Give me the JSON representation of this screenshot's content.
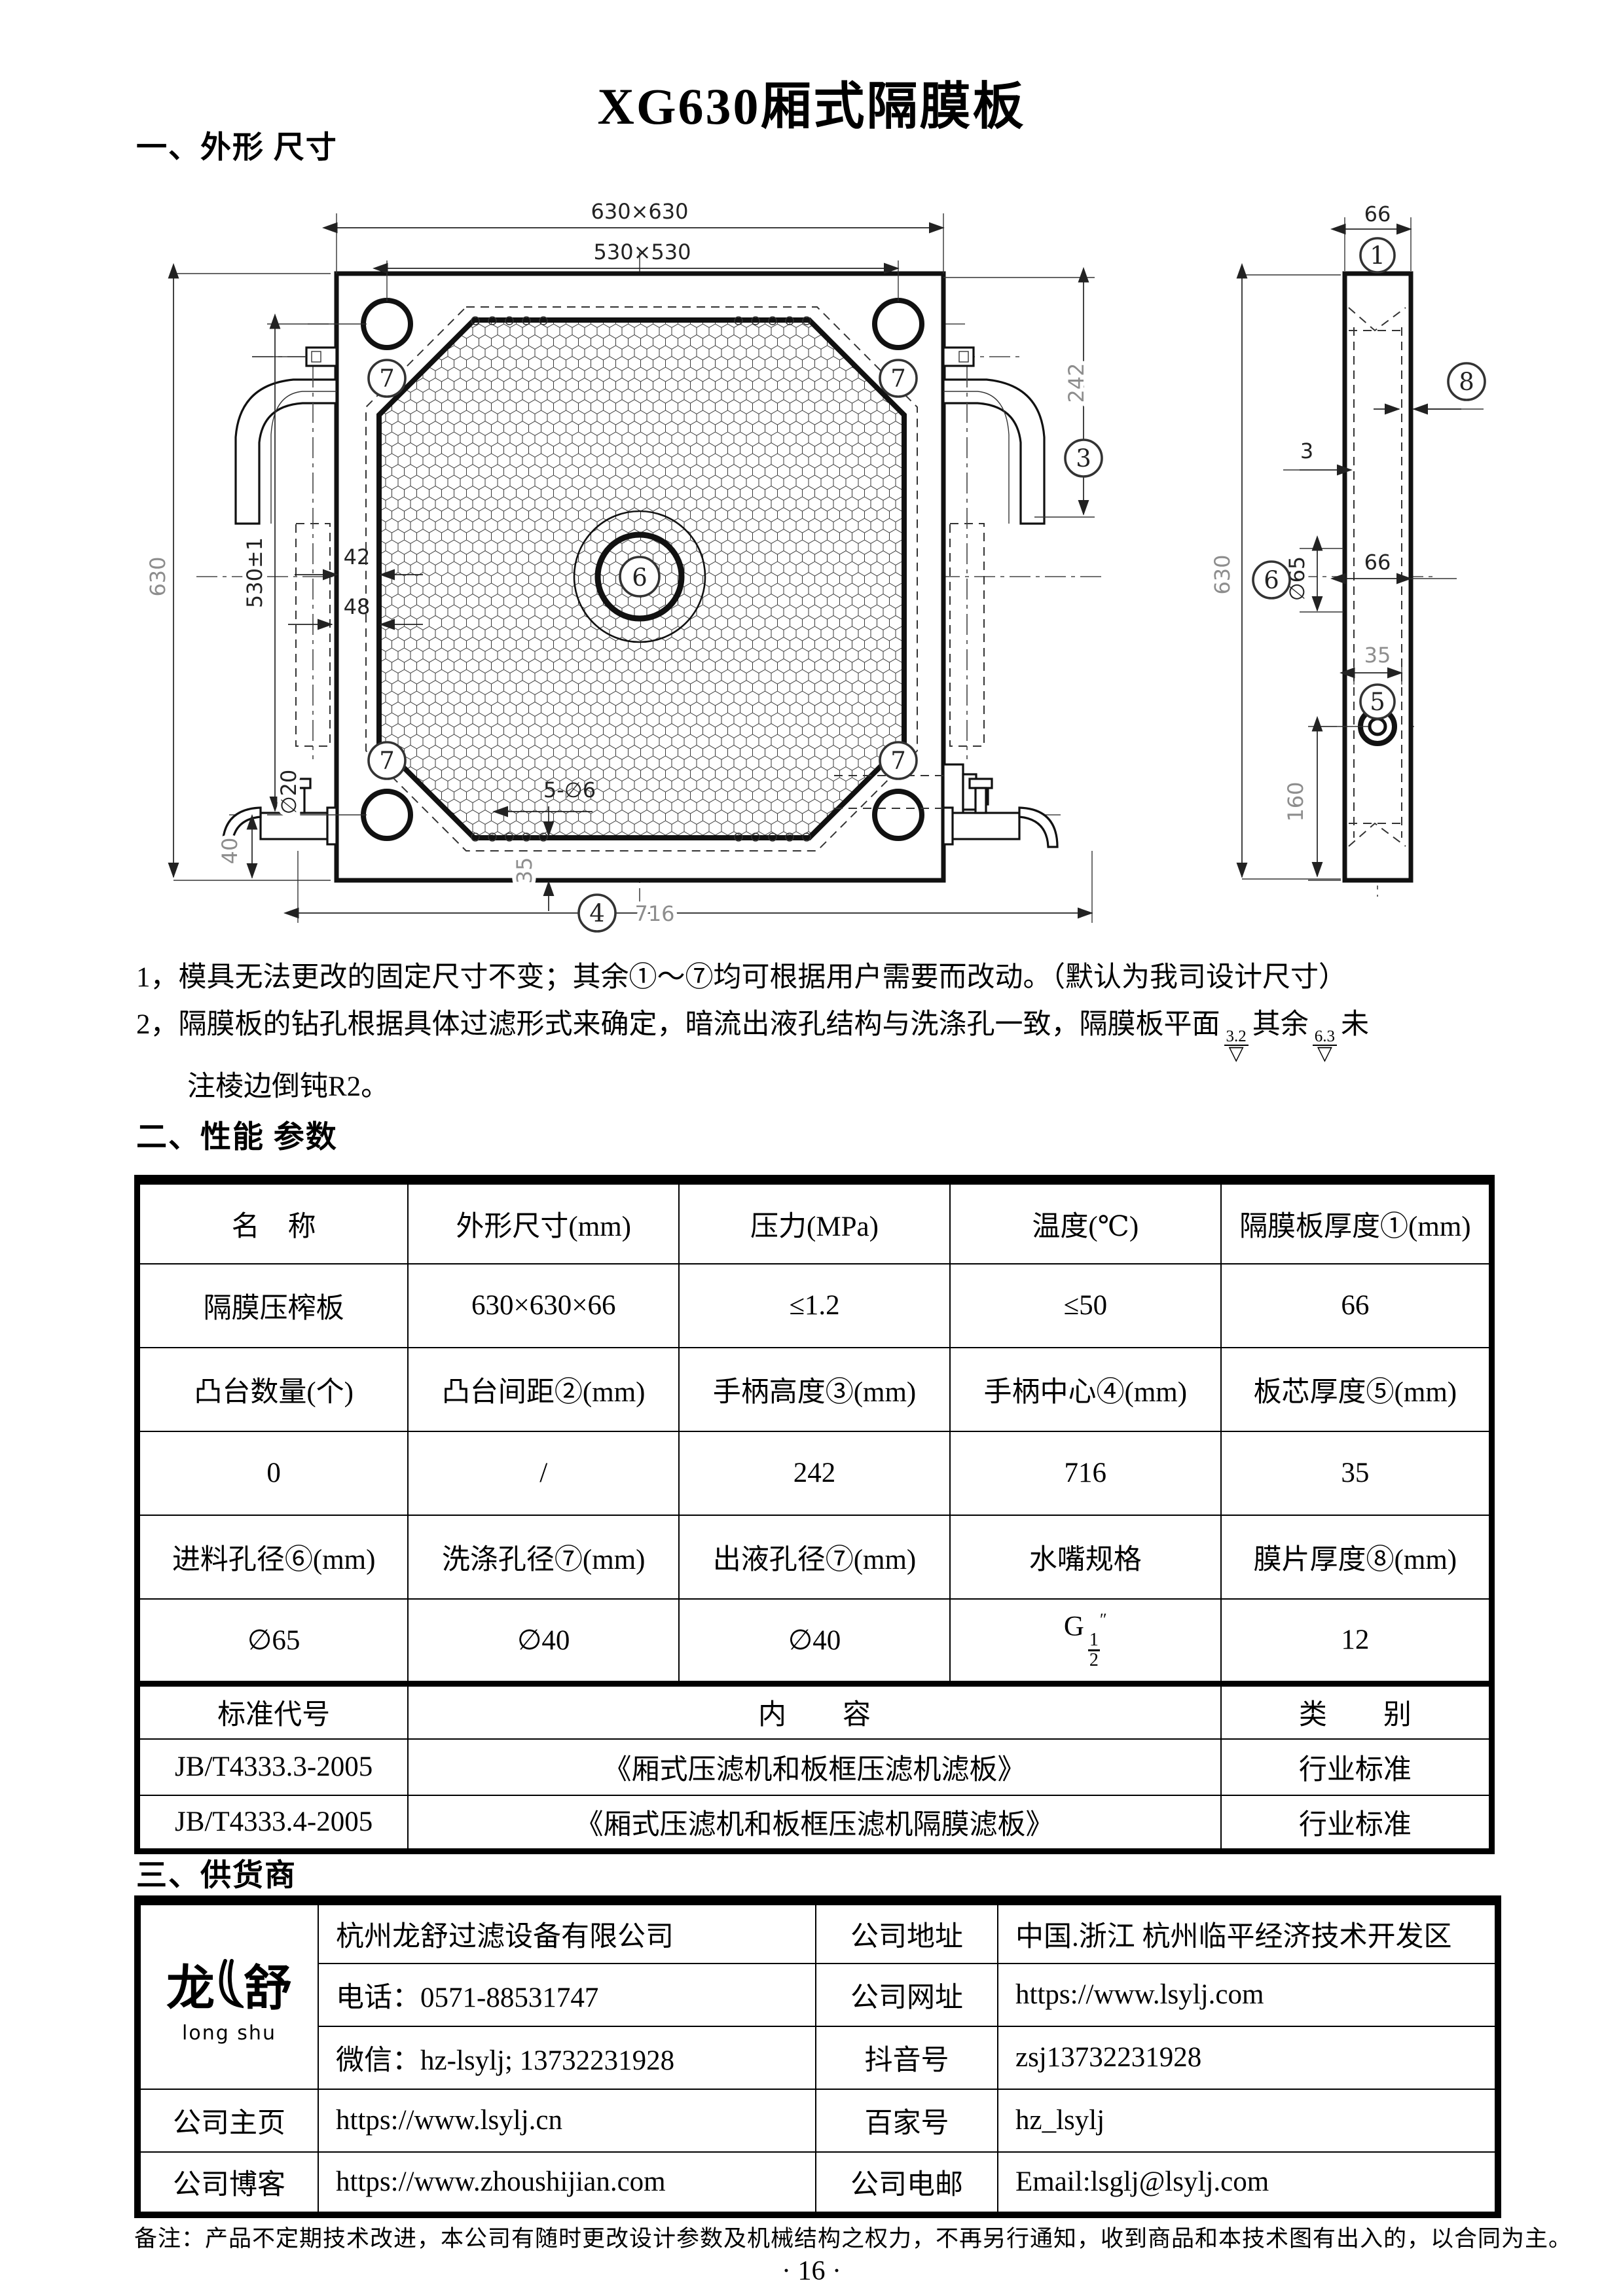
{
  "doc": {
    "title": "XG630厢式隔膜板",
    "page_number": "· 16 ·"
  },
  "sections": {
    "outline_heading": "一、外形 尺寸",
    "performance_heading": "二、性能 参数",
    "supplier_heading": "三、供货商"
  },
  "notes": {
    "line1": "1，模具无法更改的固定尺寸不变；其余①～⑦均可根据用户需要而改动。（默认为我司设计尺寸）",
    "line2_pre": "2，隔膜板的钻孔根据具体过滤形式来确定，暗流出液孔结构与洗涤孔一致，隔膜板平面",
    "rough1": "3.2",
    "rough_sym": "▽",
    "line2_mid": "其余",
    "rough2": "6.3",
    "line2_post": "未",
    "line3": "注棱边倒钝R2。"
  },
  "drawing": {
    "front": {
      "dim_outer": "630×630",
      "dim_inner": "530×530",
      "dim_left": "630",
      "dim_left_inner": "530±1",
      "dim_42": "42",
      "dim_48": "48",
      "dim_242": "242",
      "callout_3": "3",
      "dim_holes": "5-∅6",
      "dim_35": "35",
      "callout_4": "4",
      "dim_716": "716",
      "dim_d20": "∅20",
      "dim_40": "40",
      "callout_6": "6",
      "callout_7": "7"
    },
    "side": {
      "dim_width_top": "66",
      "callout_1": "1",
      "callout_8": "8",
      "dim_3": "3",
      "dim_height": "630",
      "dim_d65": "∅65",
      "callout_6": "6",
      "dim_width_mid": "66",
      "dim_core": "35",
      "callout_5": "5",
      "dim_160": "160"
    }
  },
  "perf_table": {
    "rows": [
      {
        "cells": [
          "名　称",
          "外形尺寸(mm)",
          "压力(MPa)",
          "温度(℃)",
          "隔膜板厚度①(mm)"
        ]
      },
      {
        "cells": [
          "隔膜压榨板",
          "630×630×66",
          "≤1.2",
          "≤50",
          "66"
        ]
      },
      {
        "cells": [
          "凸台数量(个)",
          "凸台间距②(mm)",
          "手柄高度③(mm)",
          "手柄中心④(mm)",
          "板芯厚度⑤(mm)"
        ]
      },
      {
        "cells": [
          "0",
          "/",
          "242",
          "716",
          "35"
        ]
      },
      {
        "cells": [
          "进料孔径⑥(mm)",
          "洗涤孔径⑦(mm)",
          "出液孔径⑦(mm)",
          "水嘴规格",
          "膜片厚度⑧(mm)"
        ]
      },
      {
        "cells": [
          "∅65",
          "∅40",
          "∅40",
          "",
          "12"
        ]
      }
    ],
    "nozzle": {
      "prefix": "G",
      "numerator": "1",
      "denominator": "2",
      "unit": "″"
    },
    "standards": {
      "header": [
        "标准代号",
        "内　　容",
        "类　　别"
      ],
      "rows": [
        {
          "code": "JB/T4333.3-2005",
          "content": "《厢式压滤机和板框压滤机滤板》",
          "category": "行业标准"
        },
        {
          "code": "JB/T4333.4-2005",
          "content": "《厢式压滤机和板框压滤机隔膜滤板》",
          "category": "行业标准"
        }
      ]
    }
  },
  "supplier_table": {
    "logo": {
      "char1": "龙",
      "char2": "舒",
      "sub": "long shu"
    },
    "rows": [
      {
        "c2": "杭州龙舒过滤设备有限公司",
        "c3": "公司地址",
        "c4": "中国.浙江 杭州临平经济技术开发区"
      },
      {
        "c2": "电话：0571-88531747",
        "c3": "公司网址",
        "c4": "https://www.lsylj.com"
      },
      {
        "c2": "微信：hz-lsylj; 13732231928",
        "c3": "抖音号",
        "c4": "zsj13732231928"
      },
      {
        "c1": "公司主页",
        "c2": "https://www.lsylj.cn",
        "c3": "百家号",
        "c4": "hz_lsylj"
      },
      {
        "c1": "公司博客",
        "c2": "https://www.zhoushijian.com",
        "c3": "公司电邮",
        "c4": "Email:lsglj@lsylj.com"
      }
    ]
  },
  "footer": {
    "note": "备注：产品不定期技术改进，本公司有随时更改设计参数及机械结构之权力，不再另行通知，收到商品和本技术图有出入的，以合同为主。"
  }
}
